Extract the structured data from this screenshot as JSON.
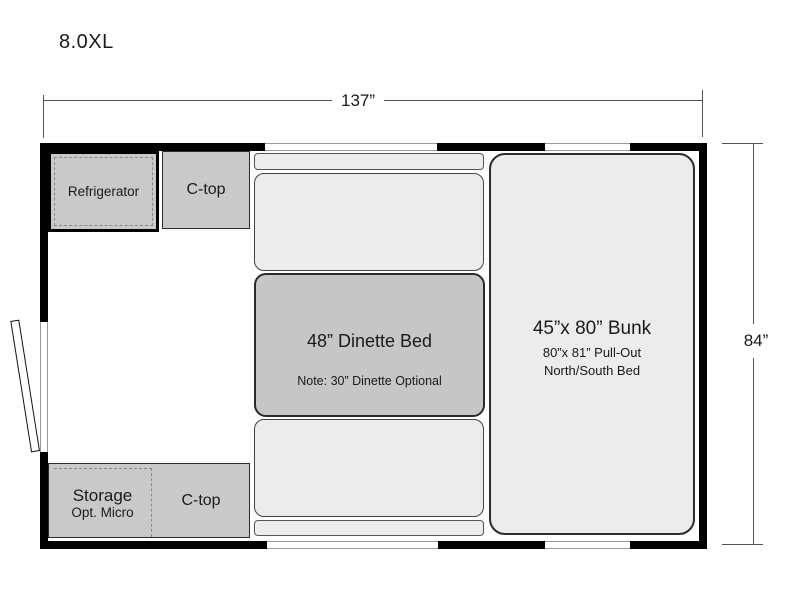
{
  "title": "8.0XL",
  "dimensions": {
    "width": "137”",
    "height": "84”"
  },
  "labels": {
    "refrigerator": "Refrigerator",
    "ctop_top": "C-top",
    "dinette_main": "48” Dinette Bed",
    "dinette_note": "Note: 30” Dinette Optional",
    "bunk_main": "45”x 80” Bunk",
    "bunk_sub1": "80”x 81” Pull-Out",
    "bunk_sub2": "North/South Bed",
    "storage_main": "Storage",
    "storage_sub": "Opt. Micro",
    "ctop_bottom": "C-top"
  },
  "colors": {
    "wall": "#000000",
    "counter_fill": "#c9c9c9",
    "cushion_fill": "#ececec",
    "table_fill": "#c6c6c6",
    "strip_fill": "#ededed",
    "dimension_line": "#555555",
    "text": "#1a1a1a"
  }
}
